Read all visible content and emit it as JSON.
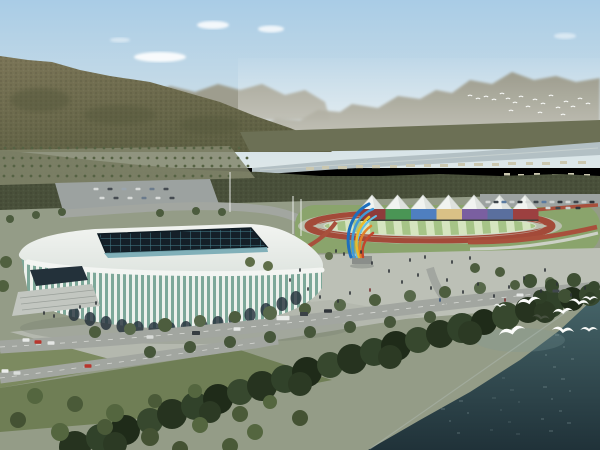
{
  "meta": {
    "subject": "aerial-rendering-stadium-complex",
    "width": 600,
    "height": 450
  },
  "palette": {
    "sky_top": "#a9cce6",
    "sky_horizon": "#dde7e8",
    "cloud": "#ffffff",
    "hills_mid": "#9a9785",
    "ridge_far": "#8e8c79",
    "mountain_top": "#7b7557",
    "mountain_bottom": "#5e6043",
    "mountain_blob": "#52563a",
    "band_far": "#6c7055",
    "river": "#b3c0c4",
    "river_light": "#d5dcd9",
    "building_far": "#cbc8b0",
    "tree_band": "#49503a",
    "orchard_ground": "#83866c",
    "orchard_dot": "#556243",
    "ground": "#949c87",
    "lawn": "#8aa46c",
    "grass1": "#7c8a60",
    "grass2": "#6f7e55",
    "plaza": "#bcc0b6",
    "plaza_front": "#b4b8ae",
    "parking": "#9ca2a0",
    "road": "#a2a6a0",
    "road_line": "#e8eae6",
    "track_red": "#a34a39",
    "track_apron": "#b9bfae",
    "field_light": "#d6e5c0",
    "field_green": "#a6c487",
    "flower_red": "#a8503c",
    "walkway": "#ccd1c6",
    "tent": "#f1f3f0",
    "tent_shade": "#d6dad6",
    "roof_light": "#f2f4f1",
    "roof_dark": "#dfe5e0",
    "roof_edge": "#f3f5f2",
    "skylight_dark": "#141f28",
    "skylight_line": "#46808e",
    "clerestory": "#76aab4",
    "rib_white": "#edf1ec",
    "rib_glass": "#7da899",
    "arch_dark": "#25313a",
    "entrance_dark": "#23313a",
    "steps": "#c2c6c0",
    "water_top": "#47666a",
    "water_bottom": "#203239",
    "water_glint": "#7b9697",
    "sparkle": "#a7bcbd",
    "shore_foam": "#b9c6c2",
    "bird_white": "#fbfcfa",
    "pole": "#e9ebe8",
    "shadow": "#6b7268",
    "sculpture_blue1": "#1d6fbe",
    "sculpture_blue2": "#3f9ad8",
    "sculpture_cyan": "#63c0e8",
    "sculpture_yellow": "#e9bc2e",
    "sculpture_orange": "#e2822a",
    "sculpture_red": "#c4452c",
    "sculpture_pedestal": "#8a8e8a"
  },
  "scene": {
    "clouds": [
      [
        213,
        25,
        16,
        4,
        0.85
      ],
      [
        160,
        57,
        26,
        5,
        0.9
      ],
      [
        271,
        29,
        13,
        3.5,
        0.8
      ],
      [
        565,
        36,
        11,
        3,
        0.5
      ],
      [
        120,
        40,
        10,
        2.5,
        0.45
      ]
    ],
    "orchard_rows": [
      {
        "y": 148,
        "x0": 4,
        "x1": 238,
        "step": 9
      },
      {
        "y": 157,
        "x0": 2,
        "x1": 248,
        "step": 9
      },
      {
        "y": 166,
        "x0": 4,
        "x1": 254,
        "step": 9
      },
      {
        "y": 175,
        "x0": 2,
        "x1": 232,
        "step": 9
      }
    ],
    "bank_buildings": [
      [
        306,
        167,
        8,
        3.2
      ],
      [
        322,
        166,
        7,
        3.2
      ],
      [
        338,
        166,
        9,
        3.2
      ],
      [
        356,
        165,
        7,
        3.2
      ],
      [
        372,
        165,
        8,
        3.2
      ],
      [
        390,
        165,
        7,
        3
      ],
      [
        406,
        164,
        9,
        3
      ],
      [
        424,
        164,
        7,
        3
      ],
      [
        440,
        164,
        8,
        3
      ],
      [
        458,
        163,
        7,
        3
      ],
      [
        474,
        163,
        9,
        3
      ],
      [
        492,
        163,
        7,
        3
      ],
      [
        508,
        162,
        8,
        3
      ],
      [
        526,
        162,
        7,
        3
      ],
      [
        542,
        162,
        8,
        3
      ],
      [
        560,
        161,
        7,
        3
      ],
      [
        578,
        161,
        8,
        3
      ],
      [
        504,
        173,
        6,
        2.5
      ],
      [
        518,
        174,
        6,
        2.5
      ],
      [
        534,
        173,
        6,
        2.5
      ],
      [
        552,
        174,
        6,
        2.5
      ],
      [
        568,
        173,
        6,
        2.5
      ],
      [
        584,
        174,
        6,
        2.5
      ]
    ],
    "tents": {
      "count": 7,
      "startX": 372,
      "gap": 25.5,
      "halfW": 13,
      "peakY": 195,
      "baseY": 210
    },
    "wall": {
      "startX": 360,
      "segW": 25.5,
      "y": 209,
      "h": 11,
      "colors": [
        "#8e3b3b",
        "#4a9555",
        "#4f7fc0",
        "#d9c186",
        "#7a5fa0",
        "#5a6f9e",
        "#9c4040"
      ]
    },
    "arena_arches": [
      [
        74,
        314
      ],
      [
        90,
        319
      ],
      [
        106,
        323
      ],
      [
        122,
        326
      ],
      [
        138,
        328
      ],
      [
        154,
        329
      ],
      [
        170,
        329
      ],
      [
        186,
        328
      ],
      [
        202,
        326
      ],
      [
        218,
        323
      ],
      [
        234,
        319
      ],
      [
        250,
        315
      ],
      [
        266,
        310
      ],
      [
        282,
        304
      ],
      [
        296,
        298
      ]
    ],
    "poles": [
      [
        230,
        172,
        212
      ],
      [
        293,
        196,
        234
      ],
      [
        301,
        199,
        236
      ]
    ],
    "trees": [
      [
        75,
        447,
        16,
        "#26331f"
      ],
      [
        100,
        438,
        14,
        "#31422a"
      ],
      [
        125,
        430,
        15,
        "#1f2b19"
      ],
      [
        150,
        421,
        13,
        "#37482e"
      ],
      [
        172,
        414,
        15,
        "#26331f"
      ],
      [
        195,
        406,
        14,
        "#31422a"
      ],
      [
        218,
        399,
        15,
        "#1f2b19"
      ],
      [
        240,
        392,
        13,
        "#37482e"
      ],
      [
        262,
        386,
        15,
        "#26331f"
      ],
      [
        285,
        379,
        14,
        "#31422a"
      ],
      [
        307,
        372,
        15,
        "#1f2b19"
      ],
      [
        330,
        365,
        13,
        "#37482e"
      ],
      [
        352,
        359,
        15,
        "#26331f"
      ],
      [
        374,
        352,
        14,
        "#31422a"
      ],
      [
        396,
        346,
        15,
        "#1f2b19"
      ],
      [
        418,
        340,
        13,
        "#37482e"
      ],
      [
        440,
        334,
        14,
        "#26331f"
      ],
      [
        462,
        328,
        15,
        "#31422a"
      ],
      [
        484,
        322,
        13,
        "#1f2b19"
      ],
      [
        506,
        316,
        14,
        "#37482e"
      ],
      [
        528,
        310,
        13,
        "#26331f"
      ],
      [
        550,
        304,
        14,
        "#31422a"
      ],
      [
        572,
        299,
        12,
        "#1f2b19"
      ],
      [
        590,
        295,
        11,
        "#37482e"
      ],
      [
        115,
        444,
        12,
        "#2c3a24"
      ],
      [
        210,
        412,
        11,
        "#2c3a24"
      ],
      [
        300,
        384,
        12,
        "#2c3a24"
      ],
      [
        390,
        357,
        12,
        "#2c3a24"
      ],
      [
        470,
        333,
        12,
        "#2c3a24"
      ],
      [
        545,
        312,
        11,
        "#2c3a24"
      ],
      [
        95,
        332,
        6,
        "#4d5d3e"
      ],
      [
        130,
        329,
        6,
        "#57684a"
      ],
      [
        165,
        325,
        7,
        "#4d5d3e"
      ],
      [
        200,
        321,
        6,
        "#57684a"
      ],
      [
        235,
        317,
        6,
        "#4d5d3e"
      ],
      [
        270,
        313,
        7,
        "#57684a"
      ],
      [
        305,
        309,
        6,
        "#4d5d3e"
      ],
      [
        340,
        305,
        6,
        "#57684a"
      ],
      [
        375,
        300,
        6,
        "#4d5d3e"
      ],
      [
        410,
        296,
        6,
        "#57684a"
      ],
      [
        445,
        292,
        6,
        "#4d5d3e"
      ],
      [
        480,
        288,
        6,
        "#57684a"
      ],
      [
        515,
        285,
        5,
        "#4d5d3e"
      ],
      [
        550,
        282,
        5,
        "#57684a"
      ],
      [
        150,
        352,
        6,
        "#46563a"
      ],
      [
        190,
        347,
        6,
        "#46563a"
      ],
      [
        230,
        342,
        6,
        "#46563a"
      ],
      [
        270,
        337,
        6,
        "#46563a"
      ],
      [
        310,
        332,
        6,
        "#46563a"
      ],
      [
        350,
        327,
        6,
        "#46563a"
      ],
      [
        390,
        322,
        6,
        "#46563a"
      ],
      [
        430,
        317,
        6,
        "#46563a"
      ],
      [
        530,
        281,
        7,
        "#3f5034"
      ],
      [
        552,
        286,
        7,
        "#37482e"
      ],
      [
        574,
        280,
        7,
        "#3f5034"
      ],
      [
        594,
        287,
        6,
        "#37482e"
      ],
      [
        540,
        297,
        7,
        "#2f3f27"
      ],
      [
        565,
        296,
        7,
        "#3f5034"
      ],
      [
        590,
        298,
        6,
        "#2f3f27"
      ],
      [
        475,
        268,
        5,
        "#4c5c3e"
      ],
      [
        500,
        272,
        5,
        "#4c5c3e"
      ],
      [
        35,
        396,
        8,
        "#54663f"
      ],
      [
        75,
        404,
        8,
        "#4a5a38"
      ],
      [
        115,
        413,
        9,
        "#54663f"
      ],
      [
        155,
        401,
        7,
        "#4a5a38"
      ],
      [
        195,
        391,
        7,
        "#54663f"
      ],
      [
        18,
        420,
        8,
        "#445233"
      ],
      [
        60,
        432,
        9,
        "#54663f"
      ],
      [
        105,
        427,
        8,
        "#4a5a38"
      ],
      [
        150,
        437,
        9,
        "#445233"
      ],
      [
        200,
        425,
        8,
        "#54663f"
      ],
      [
        240,
        414,
        8,
        "#4a5a38"
      ],
      [
        270,
        402,
        7,
        "#54663f"
      ],
      [
        300,
        418,
        8,
        "#445233"
      ],
      [
        255,
        432,
        8,
        "#54663f"
      ],
      [
        230,
        446,
        8,
        "#4a5a38"
      ],
      [
        180,
        449,
        8,
        "#445233"
      ],
      [
        10,
        219,
        4,
        "#4c5c3e"
      ],
      [
        36,
        215,
        4,
        "#4c5c3e"
      ],
      [
        62,
        212,
        4,
        "#4c5c3e"
      ],
      [
        160,
        213,
        4,
        "#4c5c3e"
      ],
      [
        196,
        211,
        4,
        "#4c5c3e"
      ],
      [
        222,
        212,
        4,
        "#4c5c3e"
      ],
      [
        6,
        262,
        6,
        "#50603f"
      ],
      [
        3,
        286,
        6,
        "#50603f"
      ],
      [
        329,
        256,
        4,
        "#5a6a46"
      ],
      [
        250,
        262,
        5,
        "#5e6e48"
      ],
      [
        268,
        266,
        5,
        "#5e6e48"
      ]
    ],
    "cars": [
      [
        26,
        340,
        7,
        3.5,
        "#e8eae8"
      ],
      [
        38,
        342,
        7,
        3.5,
        "#b8352c"
      ],
      [
        51,
        343,
        7,
        3.5,
        "#e4e6e4"
      ],
      [
        5,
        371,
        7,
        3.5,
        "#eceeec"
      ],
      [
        17,
        373,
        7,
        3.5,
        "#dadddb"
      ],
      [
        88,
        366,
        7,
        3.5,
        "#b8352c"
      ],
      [
        150,
        337,
        7,
        3.5,
        "#d9dcd9"
      ],
      [
        196,
        333,
        8,
        4,
        "#363d42"
      ],
      [
        237,
        329,
        7,
        3.5,
        "#e8eae8"
      ],
      [
        283,
        318,
        13,
        4.5,
        "#e8eae8"
      ],
      [
        304,
        314,
        8,
        4,
        "#3a4146"
      ],
      [
        328,
        311,
        8,
        3.5,
        "#2f3439"
      ],
      [
        520,
        295,
        7,
        3,
        "#e6e8e6"
      ],
      [
        556,
        291,
        7,
        3,
        "#41484e"
      ],
      [
        96,
        189,
        5,
        2.5,
        "#d8dbd9"
      ],
      [
        110,
        189,
        5,
        2.5,
        "#454b51"
      ],
      [
        124,
        189,
        5,
        2.5,
        "#9aa5ad"
      ],
      [
        138,
        189,
        5,
        2.5,
        "#d8dbd9"
      ],
      [
        152,
        189,
        5,
        2.5,
        "#6b7b8c"
      ],
      [
        166,
        189,
        5,
        2.5,
        "#454b51"
      ],
      [
        102,
        198,
        5,
        2.5,
        "#d8dbd9"
      ],
      [
        116,
        198,
        5,
        2.5,
        "#454b51"
      ],
      [
        130,
        198,
        5,
        2.5,
        "#d8dbd9"
      ],
      [
        144,
        198,
        5,
        2.5,
        "#6b7b8c"
      ],
      [
        158,
        198,
        5,
        2.5,
        "#d8dbd9"
      ],
      [
        172,
        198,
        5,
        2.5,
        "#454b51"
      ],
      [
        488,
        202,
        5,
        2.5,
        "#d5d8d6"
      ],
      [
        496,
        202,
        5,
        2.5,
        "#3f464c"
      ],
      [
        504,
        202,
        5,
        2.5,
        "#5a7aa0"
      ],
      [
        512,
        202,
        5,
        2.5,
        "#c9cdcc"
      ],
      [
        520,
        202,
        5,
        2.5,
        "#2f3439"
      ],
      [
        528,
        202,
        5,
        2.5,
        "#d5d8d6"
      ],
      [
        536,
        202,
        5,
        2.5,
        "#3f464c"
      ],
      [
        544,
        202,
        5,
        2.5,
        "#5a7aa0"
      ],
      [
        552,
        202,
        5,
        2.5,
        "#c9cdcc"
      ],
      [
        560,
        202,
        5,
        2.5,
        "#2f3439"
      ],
      [
        568,
        202,
        5,
        2.5,
        "#d5d8d6"
      ],
      [
        576,
        202,
        5,
        2.5,
        "#3f464c"
      ],
      [
        584,
        202,
        5,
        2.5,
        "#c9cdcc"
      ],
      [
        592,
        202,
        5,
        2.5,
        "#2f3439"
      ],
      [
        548,
        208,
        5,
        2.5,
        "#d5d8d6"
      ],
      [
        558,
        208,
        5,
        2.5,
        "#3f464c"
      ],
      [
        568,
        208,
        5,
        2.5,
        "#c9cdcc"
      ],
      [
        578,
        208,
        5,
        2.5,
        "#2f3439"
      ]
    ],
    "people": [
      [
        336,
        251
      ],
      [
        344,
        254
      ],
      [
        361,
        252
      ],
      [
        372,
        263
      ],
      [
        389,
        271
      ],
      [
        402,
        282
      ],
      [
        418,
        275
      ],
      [
        431,
        288
      ],
      [
        447,
        280
      ],
      [
        463,
        292
      ],
      [
        478,
        284
      ],
      [
        494,
        296
      ],
      [
        509,
        287
      ],
      [
        524,
        278
      ],
      [
        541,
        291
      ],
      [
        557,
        284
      ],
      [
        571,
        295
      ],
      [
        585,
        288
      ],
      [
        350,
        293
      ],
      [
        338,
        301
      ],
      [
        320,
        297
      ],
      [
        308,
        289
      ],
      [
        44,
        313
      ],
      [
        54,
        316
      ],
      [
        80,
        307
      ],
      [
        96,
        303
      ],
      [
        410,
        260
      ],
      [
        425,
        257
      ],
      [
        452,
        262
      ],
      [
        470,
        258
      ],
      [
        545,
        270
      ],
      [
        300,
        270
      ],
      [
        290,
        280
      ],
      [
        370,
        290,
        "#7a3030"
      ],
      [
        440,
        300,
        "#33517a"
      ],
      [
        505,
        300,
        "#7a3030"
      ]
    ],
    "birds_far": [
      [
        470,
        96
      ],
      [
        478,
        99
      ],
      [
        486,
        97
      ],
      [
        494,
        100
      ],
      [
        502,
        94
      ],
      [
        508,
        99
      ],
      [
        515,
        103
      ],
      [
        521,
        97
      ],
      [
        528,
        107
      ],
      [
        535,
        100
      ],
      [
        543,
        104
      ],
      [
        551,
        96
      ],
      [
        558,
        108
      ],
      [
        566,
        102
      ],
      [
        573,
        107
      ],
      [
        580,
        99
      ],
      [
        588,
        104
      ],
      [
        511,
        111
      ],
      [
        540,
        113
      ],
      [
        563,
        115
      ]
    ],
    "birds_near": [
      [
        529,
        302,
        1.5,
        -12,
        "#fbfcfa"
      ],
      [
        579,
        303,
        1.3,
        10,
        "#fbfcfa"
      ],
      [
        590,
        299,
        1.0,
        0,
        "#f4f6f4"
      ],
      [
        563,
        312,
        1.3,
        -6,
        "#fbfcfa"
      ],
      [
        541,
        318,
        1.1,
        8,
        "#46503f"
      ],
      [
        512,
        332,
        1.7,
        -14,
        "#fbfcfa"
      ],
      [
        563,
        331,
        1.4,
        6,
        "#fbfcfa"
      ],
      [
        589,
        330,
        1.1,
        0,
        "#f4f6f4"
      ],
      [
        500,
        306,
        0.8,
        0,
        "#eef1ee"
      ]
    ]
  }
}
